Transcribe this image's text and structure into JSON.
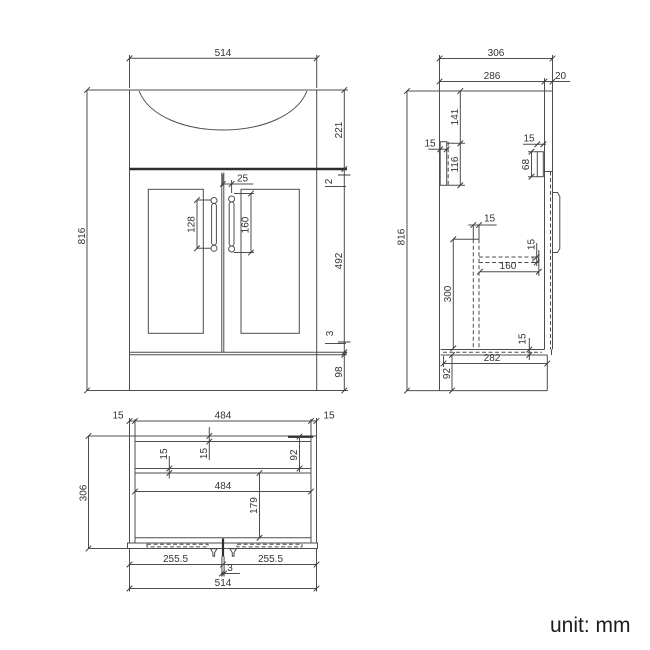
{
  "unit_label": "unit: mm",
  "front": {
    "overall_width": "514",
    "overall_height": "816",
    "basin_height": "221",
    "counter_gap": "2",
    "door_height": "492",
    "bottom_gap": "3",
    "plinth_height": "98",
    "handle_offset": "25",
    "left_handle": "128",
    "right_handle": "160"
  },
  "side": {
    "overall_depth": "306",
    "carcass_depth": "286",
    "door_thickness": "20",
    "overall_height": "816",
    "bracket_offset": "141",
    "bracket_width": "15",
    "bracket_height": "116",
    "front_bracket_width": "15",
    "front_bracket_height": "68",
    "divider_width": "15",
    "divider_height": "300",
    "shelf_thickness": "15",
    "shelf_depth": "160",
    "bottom_thickness": "15",
    "bottom_depth": "282",
    "plinth_height": "92"
  },
  "plan": {
    "left_wall": "15",
    "inner_width_top": "484",
    "right_wall": "15",
    "overall_depth": "306",
    "rail_thickness": "15",
    "back_wall": "15",
    "back_depth": "92",
    "inner_width": "484",
    "front_depth": "179",
    "left_door_width": "255.5",
    "center_gap": "3",
    "right_door_width": "255.5",
    "overall_width": "514"
  }
}
